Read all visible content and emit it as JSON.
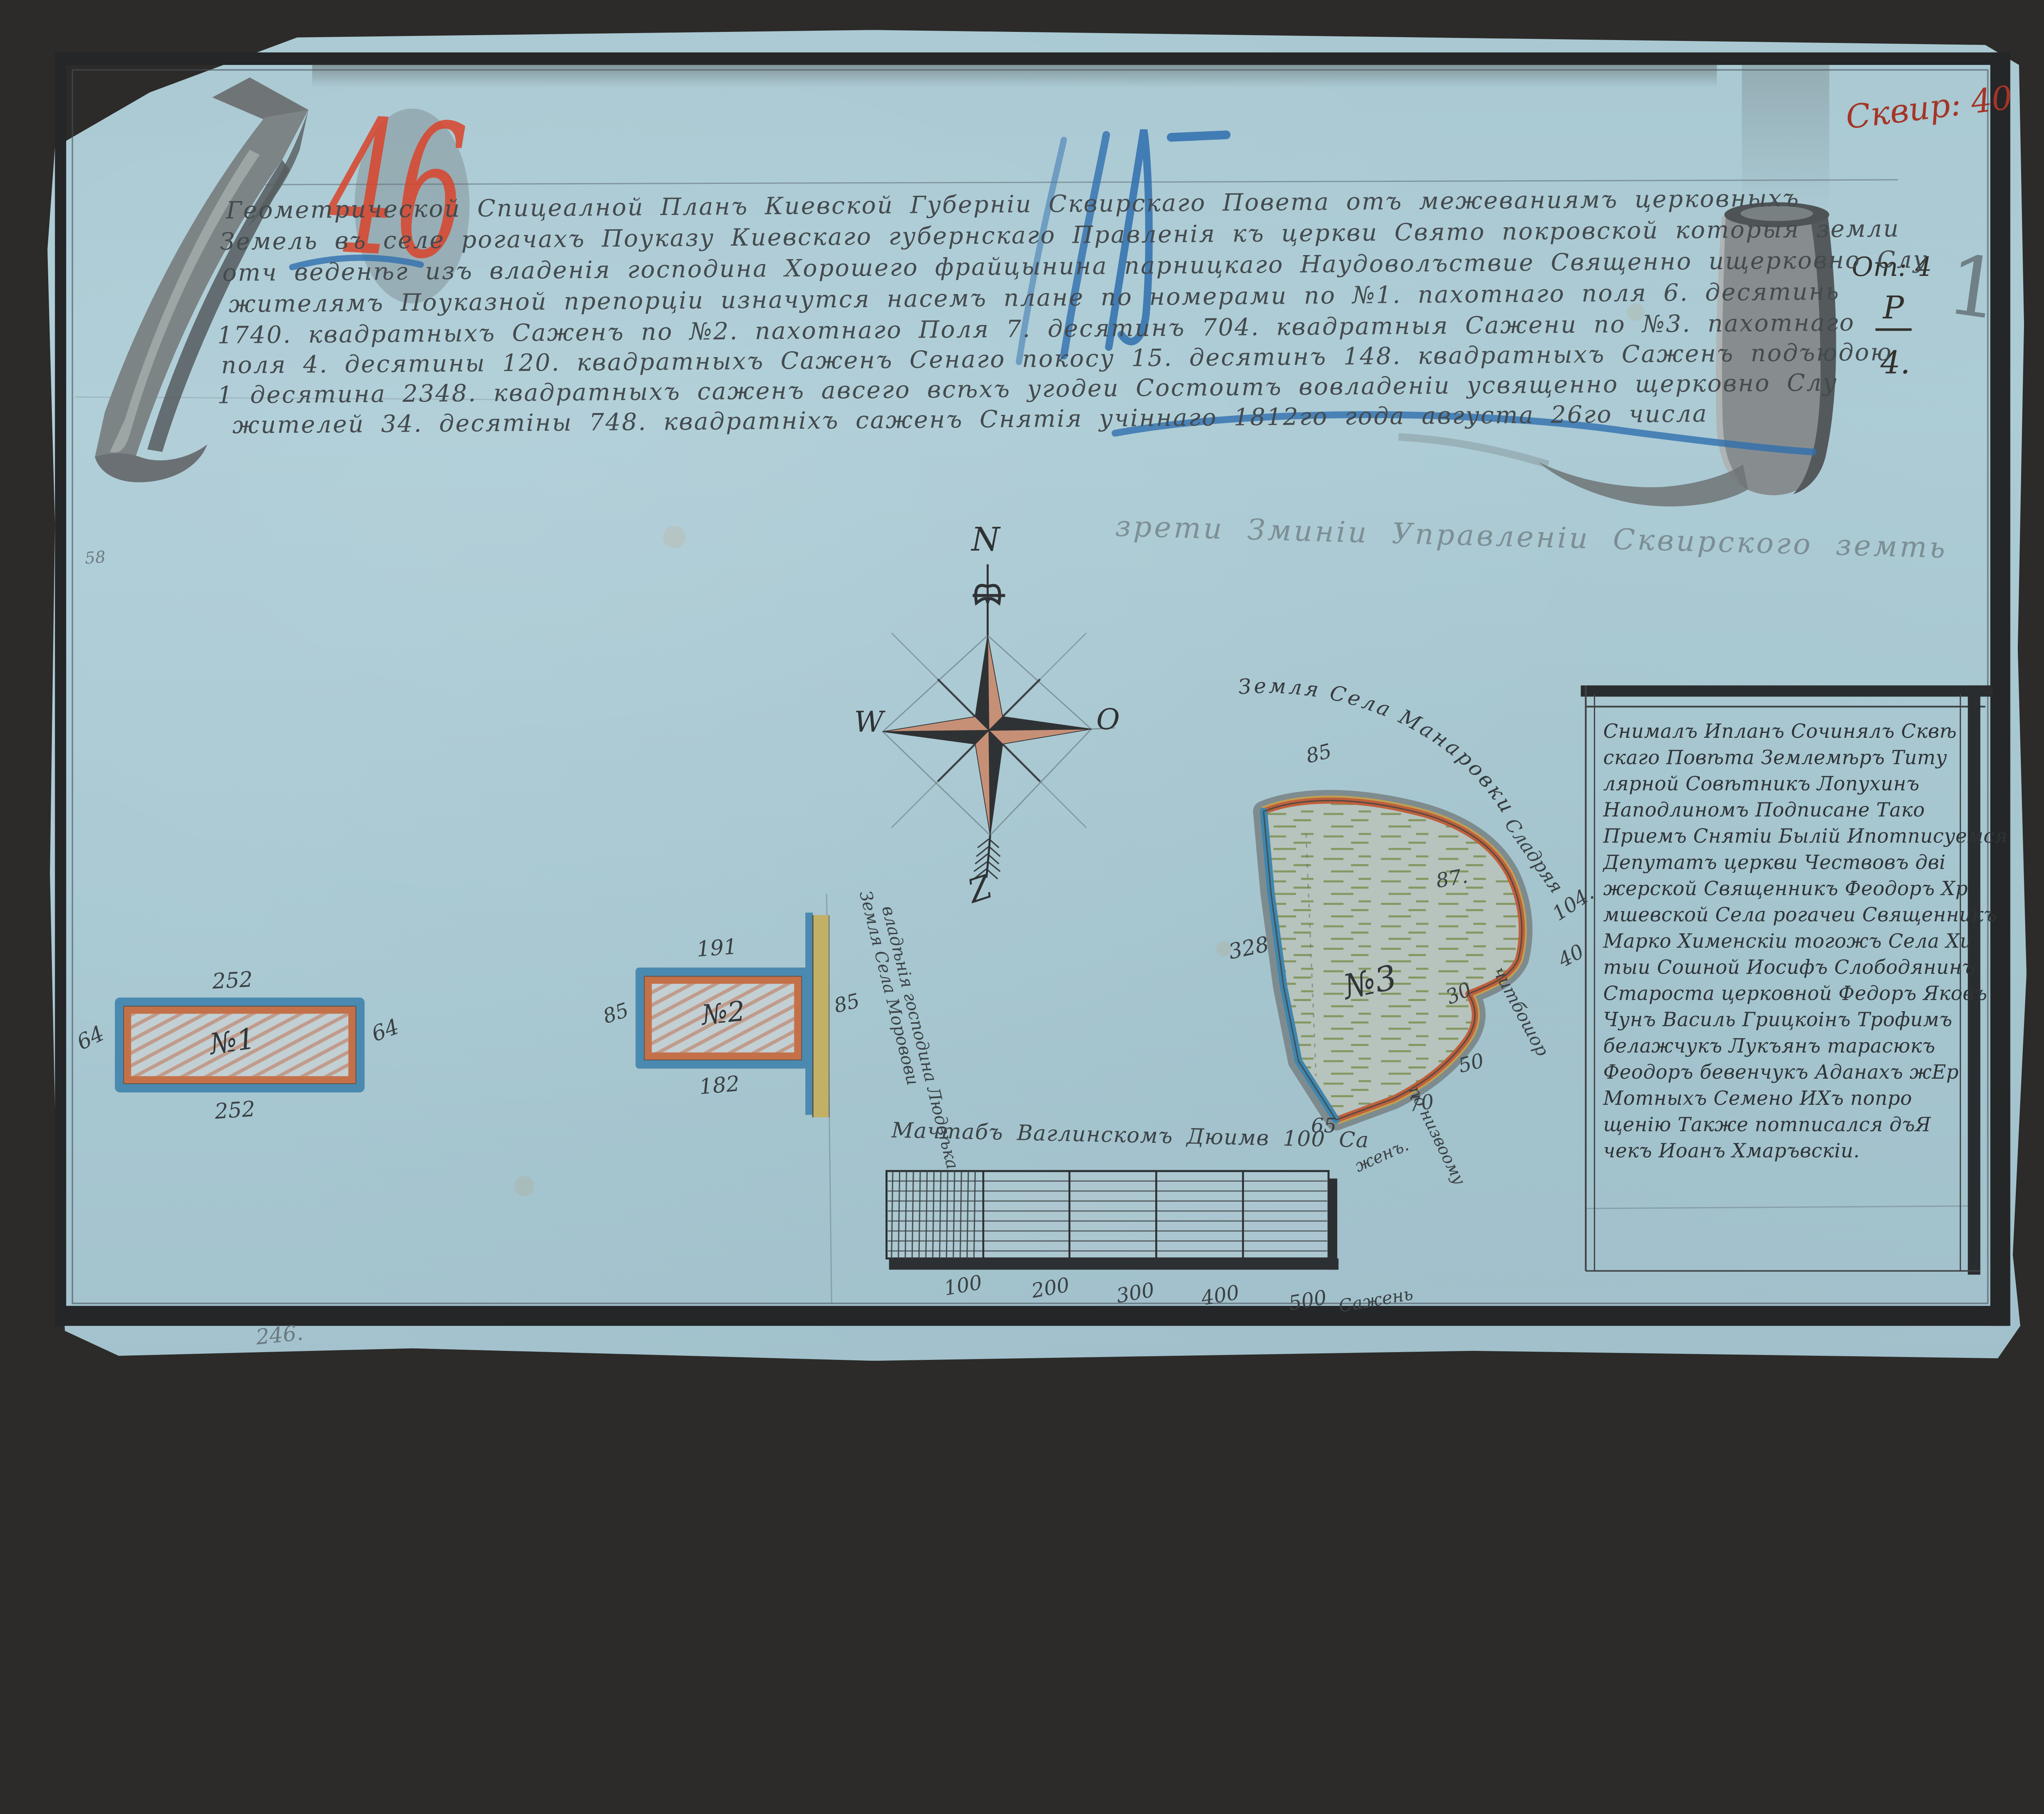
{
  "marks": {
    "red_number": "46",
    "catalog_red": "Сквир: 40",
    "ot4": "От: 4",
    "r": "Р",
    "four": "4.",
    "page_one": "1",
    "pencil_58": "58",
    "pencil_246": "246."
  },
  "title": {
    "lines": [
      "Геометрической Спицеалной Планъ Киевской Губерніи Сквирскаго Повета отъ межеваниямъ церковныхъ",
      "Земель въ селе рогачахъ Поуказу Киевскаго губернскаго Правленія къ церкви Свято покровской которыя земли",
      "отч веденѣг изъ владенія господина Хорошего фрайцынина парницкаго Наудоволъствие Священно ищерковно Слу",
      "жителямъ Поуказной препорціи изначутся насемъ плане по номерами по №1. пахотнаго поля 6. десятинь",
      "1740. квадратныхъ Саженъ по №2. пахотнаго Поля 7. десятинъ 704. квадратныя Сажени по №3. пахотнаго",
      "поля 4. десятины 120. квадратныхъ Саженъ Сенаго покосу 15. десятинъ 148. квадратныхъ Саженъ подъюдою",
      "1 десятина 2348. квадратныхъ саженъ авсего всѣхъ угодеи Состоитъ вовладеніи усвященно щерковно Слу",
      "жителей 34. десятіны 748. квадратніхъ саженъ Снятія учіннаго 1812го года августа 26го числа"
    ]
  },
  "pencil_inscription": "зрети Зминіи Управленіи Сквирского земть",
  "compass": {
    "n": "N",
    "w": "W",
    "e": "О",
    "s": "Z"
  },
  "parcel1": {
    "label": "№1",
    "top": "252",
    "bottom": "252",
    "left": "64",
    "right": "64"
  },
  "parcel2": {
    "label": "№2",
    "top": "191",
    "bottom": "182",
    "left": "85",
    "right": "85"
  },
  "parcel3": {
    "label": "№3",
    "caption": "Земля Села Манаровки",
    "n85": "85",
    "n87": "87.",
    "n104": "104.",
    "n40": "40",
    "n30": "30",
    "n50": "50",
    "n70": "70",
    "n65": "65",
    "n328": "328",
    "side1": "Сладряя",
    "side2": "читбошор",
    "side3": "по низвоому"
  },
  "neighbor": {
    "line1": "Земля Села Моровови",
    "line2": "владѣнія господина Людвѣка"
  },
  "scalebar": {
    "caption": "Мачтабъ Ваглинскомъ Дюимв 100 Са",
    "tail": "женъ.",
    "ticks": [
      "100",
      "200",
      "300",
      "400",
      "500"
    ],
    "unit": "Сажень"
  },
  "notebox": {
    "lines": [
      "Снималъ Ипланъ Сочинялъ Сквѣ",
      "скаго Повѣта Землемѣръ Титу",
      "лярной Совѣтникъ Лопухинъ",
      "Наподлиномъ Подписане Тако",
      "Приемъ Снятіи Былій Ипотписуемся",
      "Депутатъ церкви Чествовъ дві",
      "жерской Священникъ Феодоръ Хр",
      "мшевской Села рогачеи Священникъ",
      "Марко Хименскіи тогожъ Села Хи",
      "тыи Сошной Иосифъ Слободянинъ",
      "Староста церковной Федоръ Яковъ",
      "Чунъ Василь Грицкоінъ Трофимъ",
      "белажчукъ Лукъянъ тарасюкъ",
      "Феодоръ бевенчукъ Аданахъ жЕр",
      "Мотныхъ Семено ИХъ попро",
      "щенію Также потписался дъЯ",
      "чекъ Иоанъ Хмаръвскіи."
    ]
  },
  "colors": {
    "paper": "#aecdd7",
    "ink": "#3b4245",
    "red_crayon": "#d9442b",
    "blue_crayon": "#2f6fae",
    "paint_blue": "#4b8ab0",
    "paint_orange": "#c4714a",
    "paint_olive": "#c2b064",
    "grass_green": "#7c8f51",
    "frame": "#242628"
  }
}
